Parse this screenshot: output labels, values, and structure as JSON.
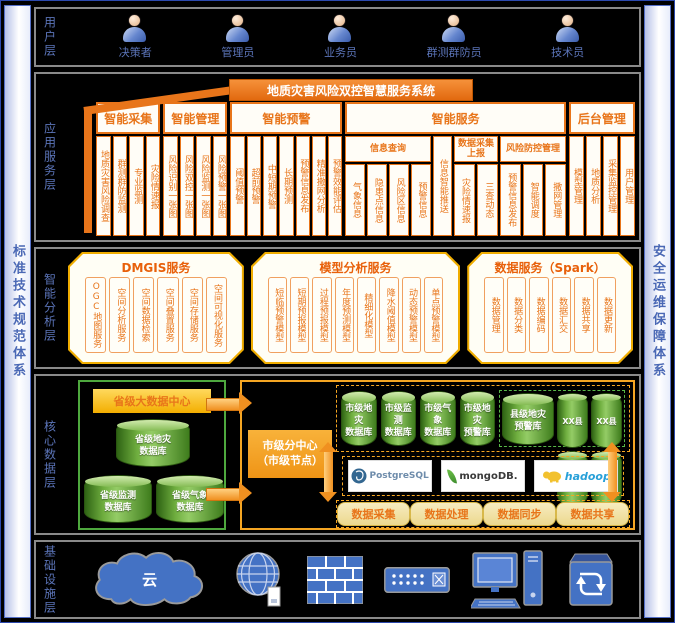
{
  "side_rails": {
    "left": "标准技术规范体系",
    "right": "安全运维保障体系"
  },
  "user": {
    "label": "用户层",
    "roles": [
      "决策者",
      "管理员",
      "业务员",
      "群测群防员",
      "技术员"
    ]
  },
  "app": {
    "label": "应用服务层",
    "banner": "地质灾害风险双控智慧服务系统",
    "groups": {
      "collect": {
        "title": "智能采集",
        "cols": [
          "地质灾害风险调查",
          "群测群防监测",
          "专业监测",
          "灾险情速报"
        ]
      },
      "manage": {
        "title": "智能管理",
        "cols": [
          "风险识别一张图",
          "风险双控一张图",
          "风险监测一张图",
          "风险预警一张图"
        ]
      },
      "warn": {
        "title": "智能预警",
        "cols": [
          "阈值预警",
          "超前预警",
          "中短期预警",
          "长期预测",
          "预警信息发布",
          "精准撒网分析",
          "预警效能评估"
        ]
      },
      "service": {
        "title": "智能服务",
        "query": {
          "title": "信息查询",
          "cols": [
            "气象信息",
            "隐患点信息",
            "风险区信息",
            "预警信息"
          ]
        },
        "push": "信息智能推送",
        "report": {
          "title": "数据采集上报",
          "cols": [
            "灾险情速报",
            "三查动态"
          ]
        },
        "control": {
          "title": "风险防控管理",
          "cols": [
            "预警信息发布",
            "智能调度",
            "撒网管理"
          ]
        }
      },
      "admin": {
        "title": "后台管理",
        "cols": [
          "模型管理",
          "地质分析",
          "采集监控管理",
          "用户管理"
        ]
      }
    }
  },
  "analysis": {
    "label": "智能分析层",
    "dmgis": {
      "title": "DMGIS服务",
      "cols": [
        "OGC地图服务",
        "空间分析服务",
        "空间数据检索",
        "空间叠置服务",
        "空间存储服务",
        "空间可视化服务"
      ]
    },
    "model": {
      "title": "模型分析服务",
      "cols": [
        "短临预警模型",
        "短期预报模型",
        "过程预报模型",
        "年度预测模型",
        "精细化模型",
        "降水阈值模型",
        "动态预警模型",
        "单点预警模型"
      ]
    },
    "spark": {
      "title": "数据服务（Spark）",
      "cols": [
        "数据管理",
        "数据分类",
        "数据编码",
        "数据汇交",
        "数据共享",
        "数据更新"
      ]
    }
  },
  "core": {
    "label": "核心数据层",
    "province": {
      "title": "省级大数据中心",
      "dbs": [
        "省级地灾\n数据库",
        "省级监测\n数据库",
        "省级气象\n数据库"
      ]
    },
    "city": {
      "label": "市级分中心\n（市级节点）",
      "dbs": [
        "市级地灾\n数据库",
        "市级监测\n数据库",
        "市级气象\n数据库",
        "市级地灾\n预警库"
      ],
      "county": {
        "main": "县级地灾\n预警库",
        "small": [
          "XX县",
          "XX县",
          "XX县",
          "XX县"
        ]
      },
      "platforms": [
        "PostgreSQL",
        "mongoDB.",
        "hadoop"
      ],
      "functions": [
        "数据采集",
        "数据处理",
        "数据同步",
        "数据共享"
      ]
    }
  },
  "infra": {
    "label": "基础设施层",
    "cloud_text": "云"
  },
  "colors": {
    "accent_orange": "#E8751A",
    "gold": "#F0AD00",
    "db_green": "#3F7D1D",
    "infra_blue": "#4472C4",
    "label_blue": "#5B74B8",
    "black_bg": "#000000"
  }
}
